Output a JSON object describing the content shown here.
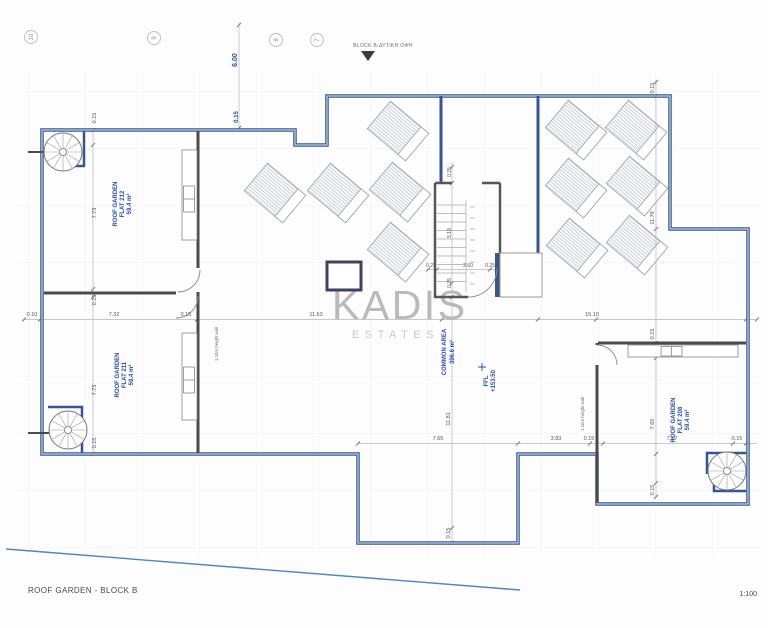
{
  "header": {
    "grid_bubbles": [
      "10",
      "9",
      "8",
      "7"
    ],
    "block_label": "BLOCK B-ΔΥΤΙΚΗ ΟΨΗ"
  },
  "watermark": {
    "name": "KADIS",
    "sub": "ESTATES"
  },
  "rooms": {
    "flat212": {
      "l1": "ROOF GARDEN",
      "l2": "FLAT 212",
      "l3": "59.4 m²"
    },
    "flat211": {
      "l1": "ROOF GARDEN",
      "l2": "FLAT 211",
      "l3": "59.4 m²"
    },
    "flat208": {
      "l1": "ROOF GARDEN",
      "l2": "FLAT 208",
      "l3": "59.4 m²"
    },
    "common": {
      "l1": "COMMON AREA",
      "l2": "396.6 m²"
    },
    "ffl": {
      "l1": "FFL",
      "l2": "+153.50"
    }
  },
  "notes": {
    "wall1": "1.10m height wall",
    "wall2": "1.10m height wall"
  },
  "dims": {
    "top": [
      "6.00",
      "0.15"
    ],
    "left_col": [
      "0.15",
      "7.73",
      "0.15",
      "7.73",
      "0.15"
    ],
    "mid_row": [
      "0.10",
      "7.32",
      "0.15",
      "11.63",
      "15.10"
    ],
    "stair_col": [
      "0.25",
      "5.19",
      "0.25"
    ],
    "stair_row": [
      "0.25",
      "2.60",
      "0.25"
    ],
    "center_col": [
      "11.81",
      "0.15"
    ],
    "right_col": [
      "0.15",
      "11.79",
      "0.15",
      "7.65",
      "0.15"
    ],
    "bottom_row": [
      "7.65",
      "3.83",
      "0.15",
      "7.17",
      "0.15"
    ]
  },
  "footer": {
    "title": "ROOF GARDEN - BLOCK B",
    "scale": "1:100"
  },
  "colors": {
    "wall_blue": "#35568f",
    "wall_dark": "#4a4a4a",
    "dim_blue": "#2b4d9b",
    "label_blue": "#2b4da0",
    "watermark": "#b9b9be"
  }
}
